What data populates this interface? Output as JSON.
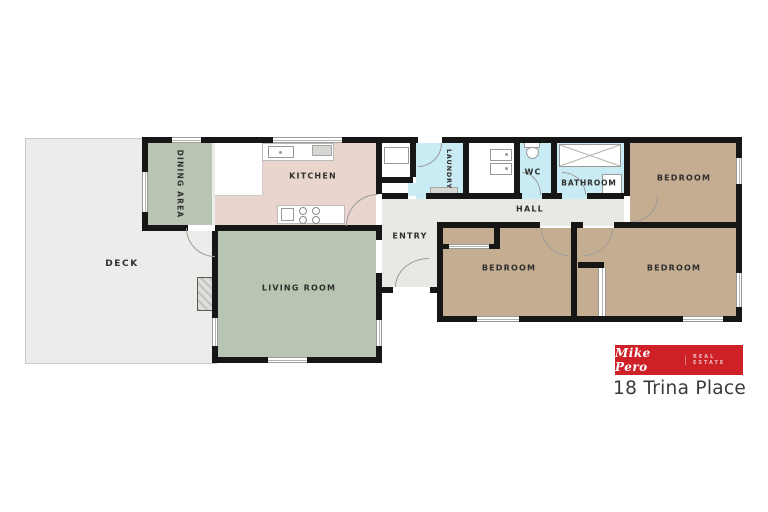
{
  "colors": {
    "wall": "#161616",
    "deck": "#ececea",
    "green": "#b7c5b2",
    "pink": "#ead4ce",
    "cyan": "#c9ecf4",
    "tan": "#c5ad92",
    "hall": "#e8e8e5",
    "label": "#2f2f2d",
    "logoRed": "#cd2127",
    "address": "#3a3a3a"
  },
  "rooms": {
    "deck": {
      "label": "DECK"
    },
    "dining": {
      "label": "DINING AREA"
    },
    "kitchen": {
      "label": "KITCHEN"
    },
    "living": {
      "label": "LIVING ROOM"
    },
    "entry": {
      "label": "ENTRY"
    },
    "hall": {
      "label": "HALL"
    },
    "laundry": {
      "label": "LAUNDRY"
    },
    "wc": {
      "label": "WC"
    },
    "bathroom": {
      "label": "BATHROOM"
    },
    "bedroom1": {
      "label": "BEDROOM"
    },
    "bedroom2": {
      "label": "BEDROOM"
    },
    "bedroom3": {
      "label": "BEDROOM"
    }
  },
  "branding": {
    "agency_script": "Mike Pero",
    "divider": "|",
    "agency_suffix": "REAL ESTATE",
    "address": "18 Trina Place"
  }
}
